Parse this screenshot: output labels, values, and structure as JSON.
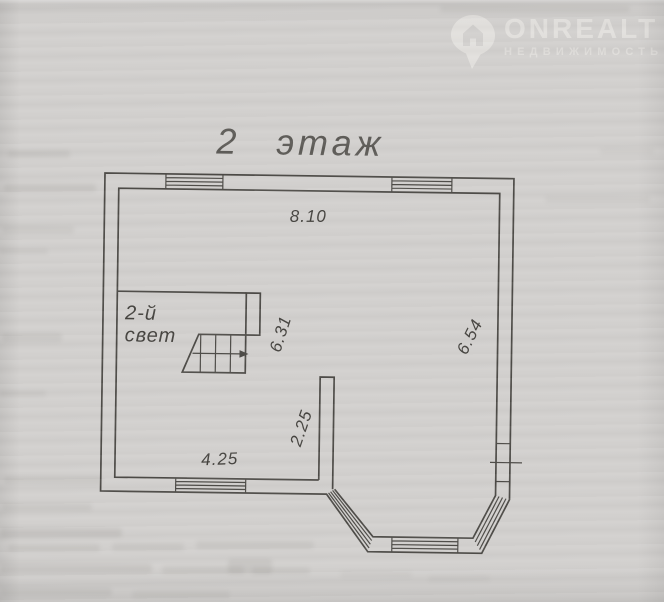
{
  "colors": {
    "paper": "#d2d0ce",
    "line": "#4c4a46",
    "dim-text": "#44423e",
    "title-text": "#5d5b57",
    "watermark": "#f0eeea"
  },
  "watermark": {
    "brand": "ONREALT",
    "subtitle": "НЕДВИЖИМОСТЬ",
    "icon": "location-pin-with-house"
  },
  "plan": {
    "title": "2 этаж",
    "void_label": {
      "line1": "2-й",
      "line2": "свет"
    },
    "dimensions": {
      "top_wall": "8.10",
      "left_void": "6.31",
      "right_wall": "6.54",
      "partition": "2.25",
      "bottom_wall": "4.25"
    }
  }
}
